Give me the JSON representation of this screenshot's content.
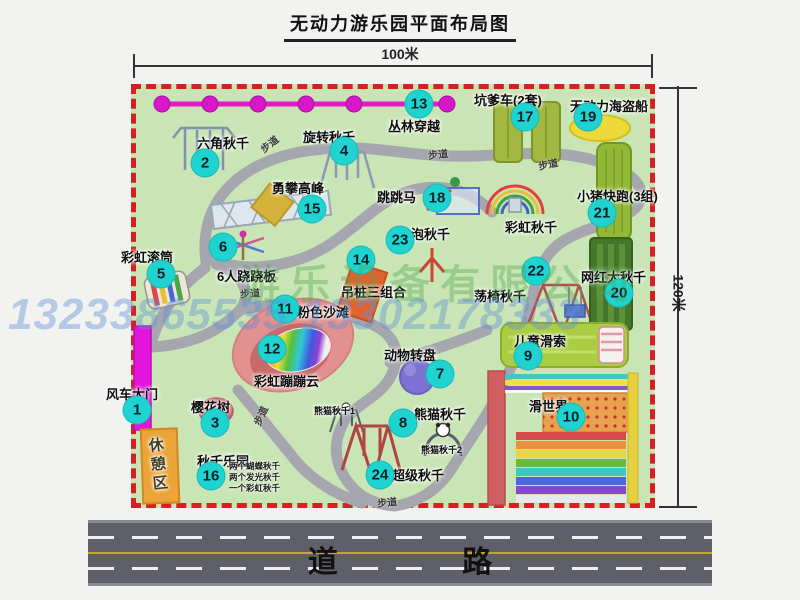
{
  "title": "无动力游乐园平面布局图",
  "dimensions": {
    "width_label": "100米",
    "height_label": "120米"
  },
  "road": {
    "label": "道 路"
  },
  "watermark": {
    "company": "游乐设备有限公司",
    "phone": "13233865535 13302178333"
  },
  "map": {
    "attractions": [
      {
        "num": "1",
        "name": "风车大门",
        "label": [
          106,
          384
        ],
        "badge": [
          137,
          410
        ]
      },
      {
        "num": "2",
        "name": "六角秋千",
        "label": [
          197,
          133
        ],
        "badge": [
          205,
          163
        ]
      },
      {
        "num": "3",
        "name": "樱花树",
        "label": [
          191,
          397
        ],
        "badge": [
          215,
          423
        ]
      },
      {
        "num": "4",
        "name": "旋转秋千",
        "label": [
          303,
          127
        ],
        "badge": [
          344,
          151
        ]
      },
      {
        "num": "5",
        "name": "彩虹滚筒",
        "label": [
          121,
          247
        ],
        "badge": [
          161,
          274
        ]
      },
      {
        "num": "6",
        "name": "6人跷跷板",
        "label": [
          217,
          266
        ],
        "badge": [
          223,
          247
        ]
      },
      {
        "num": "7",
        "name": "动物转盘",
        "label": [
          384,
          345
        ],
        "badge": [
          440,
          374
        ]
      },
      {
        "num": "8",
        "name": "熊猫秋千",
        "label": [
          414,
          404
        ],
        "badge": [
          403,
          423
        ]
      },
      {
        "num": "9",
        "name": "儿童滑索",
        "label": [
          514,
          331
        ],
        "badge": [
          528,
          356
        ]
      },
      {
        "num": "10",
        "name": "滑世界",
        "label": [
          529,
          396
        ],
        "badge": [
          571,
          417
        ]
      },
      {
        "num": "11",
        "name": "粉色沙滩",
        "label": [
          297,
          302
        ],
        "badge": [
          285,
          309
        ]
      },
      {
        "num": "12",
        "name": "彩虹蹦蹦云",
        "label": [
          254,
          371
        ],
        "badge": [
          272,
          349
        ]
      },
      {
        "num": "13",
        "name": "丛林穿越",
        "label": [
          388,
          116
        ],
        "badge": [
          419,
          104
        ]
      },
      {
        "num": "14",
        "name": "吊桩三组合",
        "label": [
          341,
          282
        ],
        "badge": [
          361,
          260
        ]
      },
      {
        "num": "15",
        "name": "勇攀高峰",
        "label": [
          272,
          178
        ],
        "badge": [
          312,
          209
        ]
      },
      {
        "num": "16",
        "name": "秋千乐园",
        "label": [
          197,
          451
        ],
        "badge": [
          211,
          476
        ],
        "sub": {
          "pos": [
            229,
            461
          ],
          "lines": [
            "两个蝴蝶秋千",
            "两个发光秋千",
            "一个彩虹秋千"
          ]
        }
      },
      {
        "num": "17",
        "name": "坑爹车(2套)",
        "label": [
          474,
          90
        ],
        "badge": [
          525,
          117
        ]
      },
      {
        "num": "18",
        "name": "跳跳马",
        "label": [
          377,
          187
        ],
        "badge": [
          437,
          198
        ]
      },
      {
        "num": "19",
        "name": "无动力海盗船",
        "label": [
          570,
          96
        ],
        "badge": [
          588,
          117
        ]
      },
      {
        "num": "20",
        "name": "网红大秋千",
        "label": [
          581,
          267
        ],
        "badge": [
          619,
          293
        ]
      },
      {
        "num": "21",
        "name": "小猪快跑(3组)",
        "label": [
          577,
          186
        ],
        "badge": [
          602,
          213
        ]
      },
      {
        "num": "22",
        "name": "荡椅秋千",
        "label": [
          474,
          286
        ],
        "badge": [
          536,
          271
        ]
      },
      {
        "num": "23",
        "name": "泡泡秋千",
        "label": [
          398,
          224
        ],
        "badge": [
          400,
          240
        ]
      },
      {
        "num": "24",
        "name": "超级秋千",
        "label": [
          392,
          465
        ],
        "badge": [
          380,
          475
        ]
      }
    ],
    "extra_labels": [
      {
        "text": "彩虹秋千",
        "pos": [
          505,
          217
        ]
      },
      {
        "text": "休憩区",
        "pos": [
          147,
          437
        ],
        "vertical": true
      },
      {
        "text": "熊猫秋千1",
        "pos": [
          314,
          404
        ],
        "small": true
      },
      {
        "text": "熊猫秋千2",
        "pos": [
          421,
          443
        ],
        "small": true
      }
    ],
    "path_labels": [
      {
        "text": "步道",
        "pos": [
          259,
          136
        ],
        "rot": -38
      },
      {
        "text": "步道",
        "pos": [
          428,
          146
        ],
        "rot": -6
      },
      {
        "text": "步道",
        "pos": [
          538,
          156
        ],
        "rot": -12
      },
      {
        "text": "步道",
        "pos": [
          240,
          285
        ],
        "rot": -4
      },
      {
        "text": "步道",
        "pos": [
          250,
          408
        ],
        "rot": -65
      },
      {
        "text": "步道",
        "pos": [
          377,
          494
        ],
        "rot": -6
      }
    ],
    "colors": {
      "map_green": "#c9e5b5",
      "border_red": "#d42020",
      "badge_cyan": "#1fd3d1",
      "zipline_magenta": "#e21ccb",
      "gate_magenta": "#e414dc",
      "road_gray": "#5f5f69"
    }
  }
}
